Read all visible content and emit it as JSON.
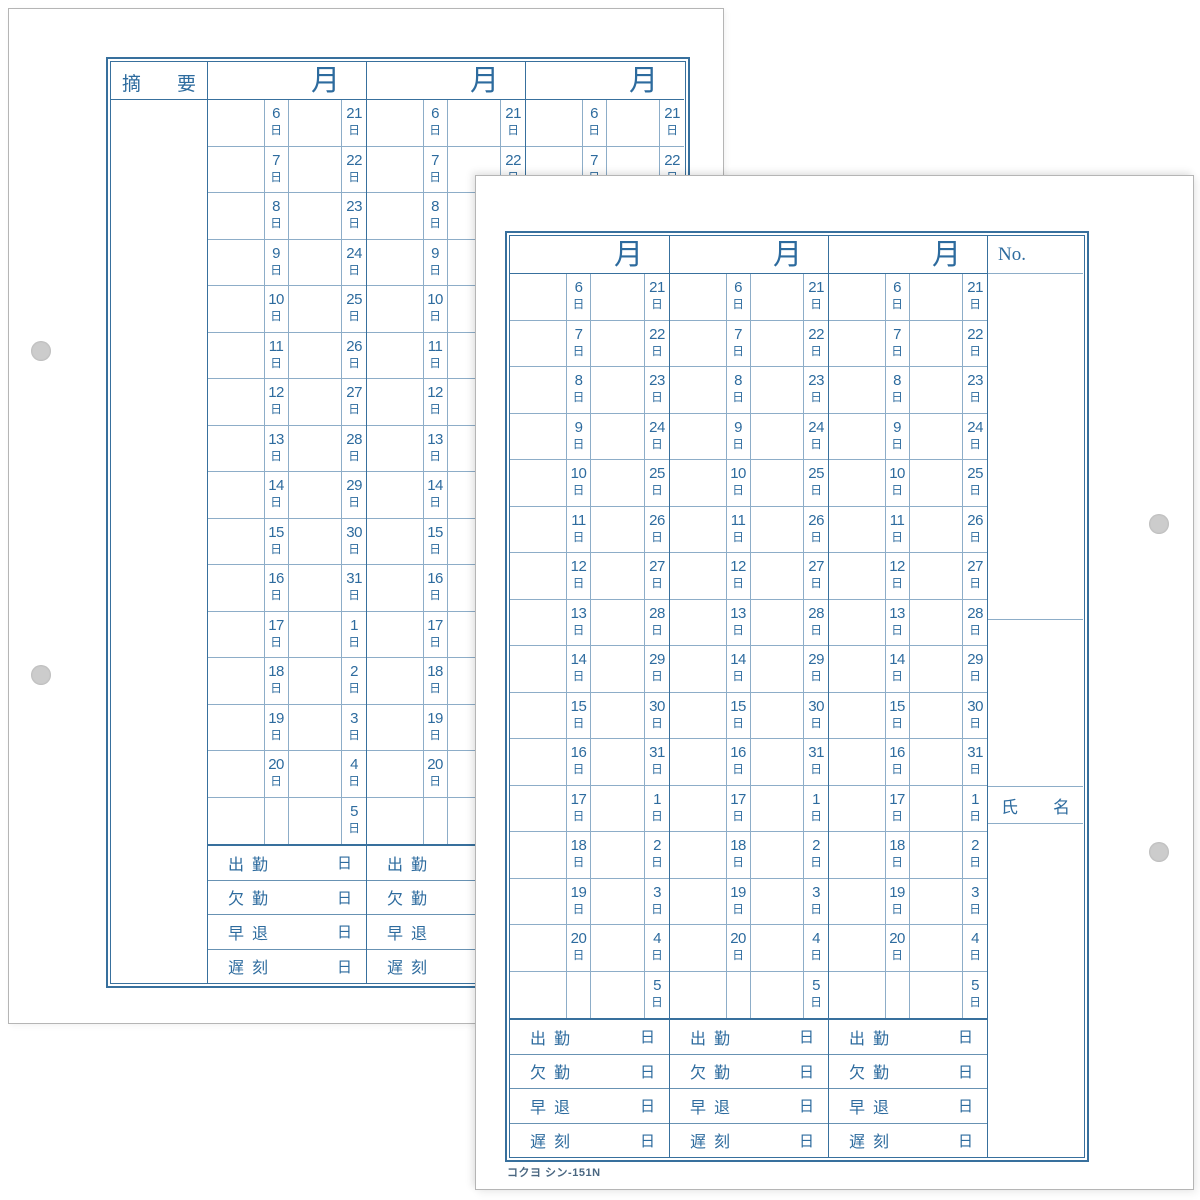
{
  "colors": {
    "line_strong": "#38709d",
    "line_light": "#8dadc8",
    "line_medium": "#6892b3",
    "ink": "#2d6b9e",
    "footer_ink": "#4a6781",
    "hole_gray": "#cccccc"
  },
  "calendar": {
    "month_header": "月",
    "day_unit": "日",
    "rows": [
      {
        "left": "6",
        "right": "21"
      },
      {
        "left": "7",
        "right": "22"
      },
      {
        "left": "8",
        "right": "23"
      },
      {
        "left": "9",
        "right": "24"
      },
      {
        "left": "10",
        "right": "25"
      },
      {
        "left": "11",
        "right": "26"
      },
      {
        "left": "12",
        "right": "27"
      },
      {
        "left": "13",
        "right": "28"
      },
      {
        "left": "14",
        "right": "29"
      },
      {
        "left": "15",
        "right": "30"
      },
      {
        "left": "16",
        "right": "31"
      },
      {
        "left": "17",
        "right": "1"
      },
      {
        "left": "18",
        "right": "2"
      },
      {
        "left": "19",
        "right": "3"
      },
      {
        "left": "20",
        "right": "4"
      },
      {
        "left": "",
        "right": "5"
      }
    ],
    "summary": [
      {
        "label": "出 勤",
        "unit": "日"
      },
      {
        "label": "欠 勤",
        "unit": "日"
      },
      {
        "label": "早 退",
        "unit": "日"
      },
      {
        "label": "遅 刻",
        "unit": "日"
      }
    ]
  },
  "front_sheet": {
    "no_label": "No.",
    "name_label": "氏　名",
    "footer_code": "コクヨ シン-151N"
  },
  "back_sheet": {
    "remarks_label": "摘　要"
  }
}
